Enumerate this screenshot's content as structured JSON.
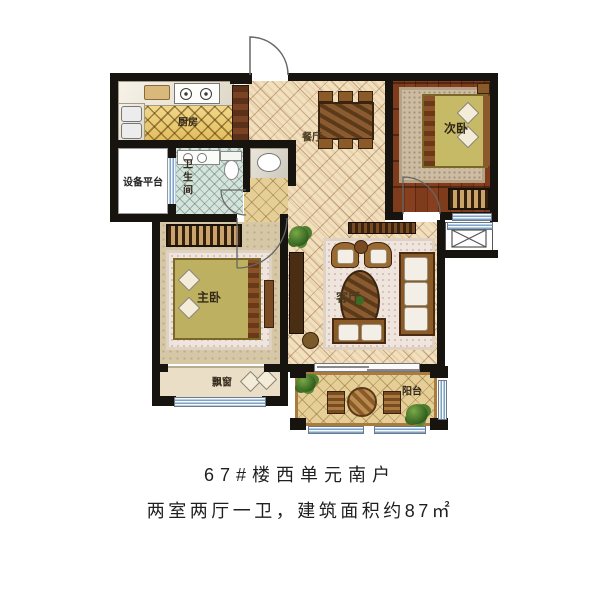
{
  "caption": {
    "line1": "67#楼西单元南户",
    "line2": "两室两厅一卫，建筑面积约87㎡"
  },
  "rooms": {
    "kitchen": {
      "label": "厨房"
    },
    "dining_room": {
      "label": "餐厅"
    },
    "secondary_bedroom": {
      "label": "次卧"
    },
    "equipment_platform": {
      "label": "设备平台"
    },
    "bathroom": {
      "label": "卫生间"
    },
    "master_bedroom": {
      "label": "主卧"
    },
    "living_room": {
      "label": "客厅"
    },
    "bay_window": {
      "label": "飘窗"
    },
    "balcony": {
      "label": "阳台"
    }
  },
  "palette": {
    "wall": "#17130e",
    "main_tile": "#f1e0bd",
    "gold_tile": "#eac86e",
    "wood_floor": "#7a3a1c",
    "bath_tile": "#d4e4dc",
    "window_blue": "#7fa3c8",
    "bed_blanket": "#c3b766",
    "caption_text": "#1f1f1f"
  }
}
